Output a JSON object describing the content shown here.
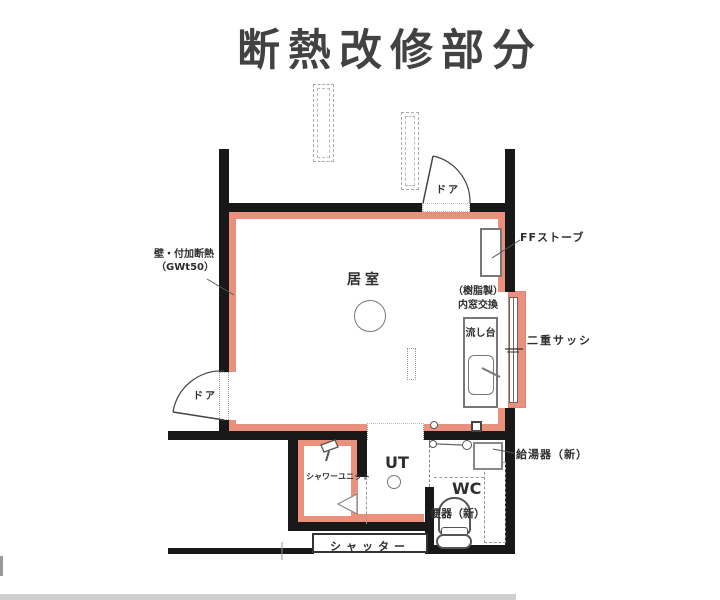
{
  "title": "断熱改修部分",
  "plan": {
    "rooms": {
      "living": "居室",
      "utility": "UT",
      "wc": "WC"
    },
    "annotations": {
      "wall_insulation_line1": "壁・付加断熱",
      "wall_insulation_line2": "（GWt50）",
      "door_top": "ドア",
      "door_left": "ドア",
      "ff_stove": "FFストーブ",
      "inner_window_line1": "（樹脂製）",
      "inner_window_line2": "内窓交換",
      "sink": "流し台",
      "double_sash": "二重サッシ",
      "water_heater": "給湯器（新）",
      "shower_unit": "シャワーユニット",
      "toilet": "便器（新）",
      "shutter": "シャッター"
    },
    "colors": {
      "wall": "#181818",
      "insulation": "#ec907e"
    }
  }
}
